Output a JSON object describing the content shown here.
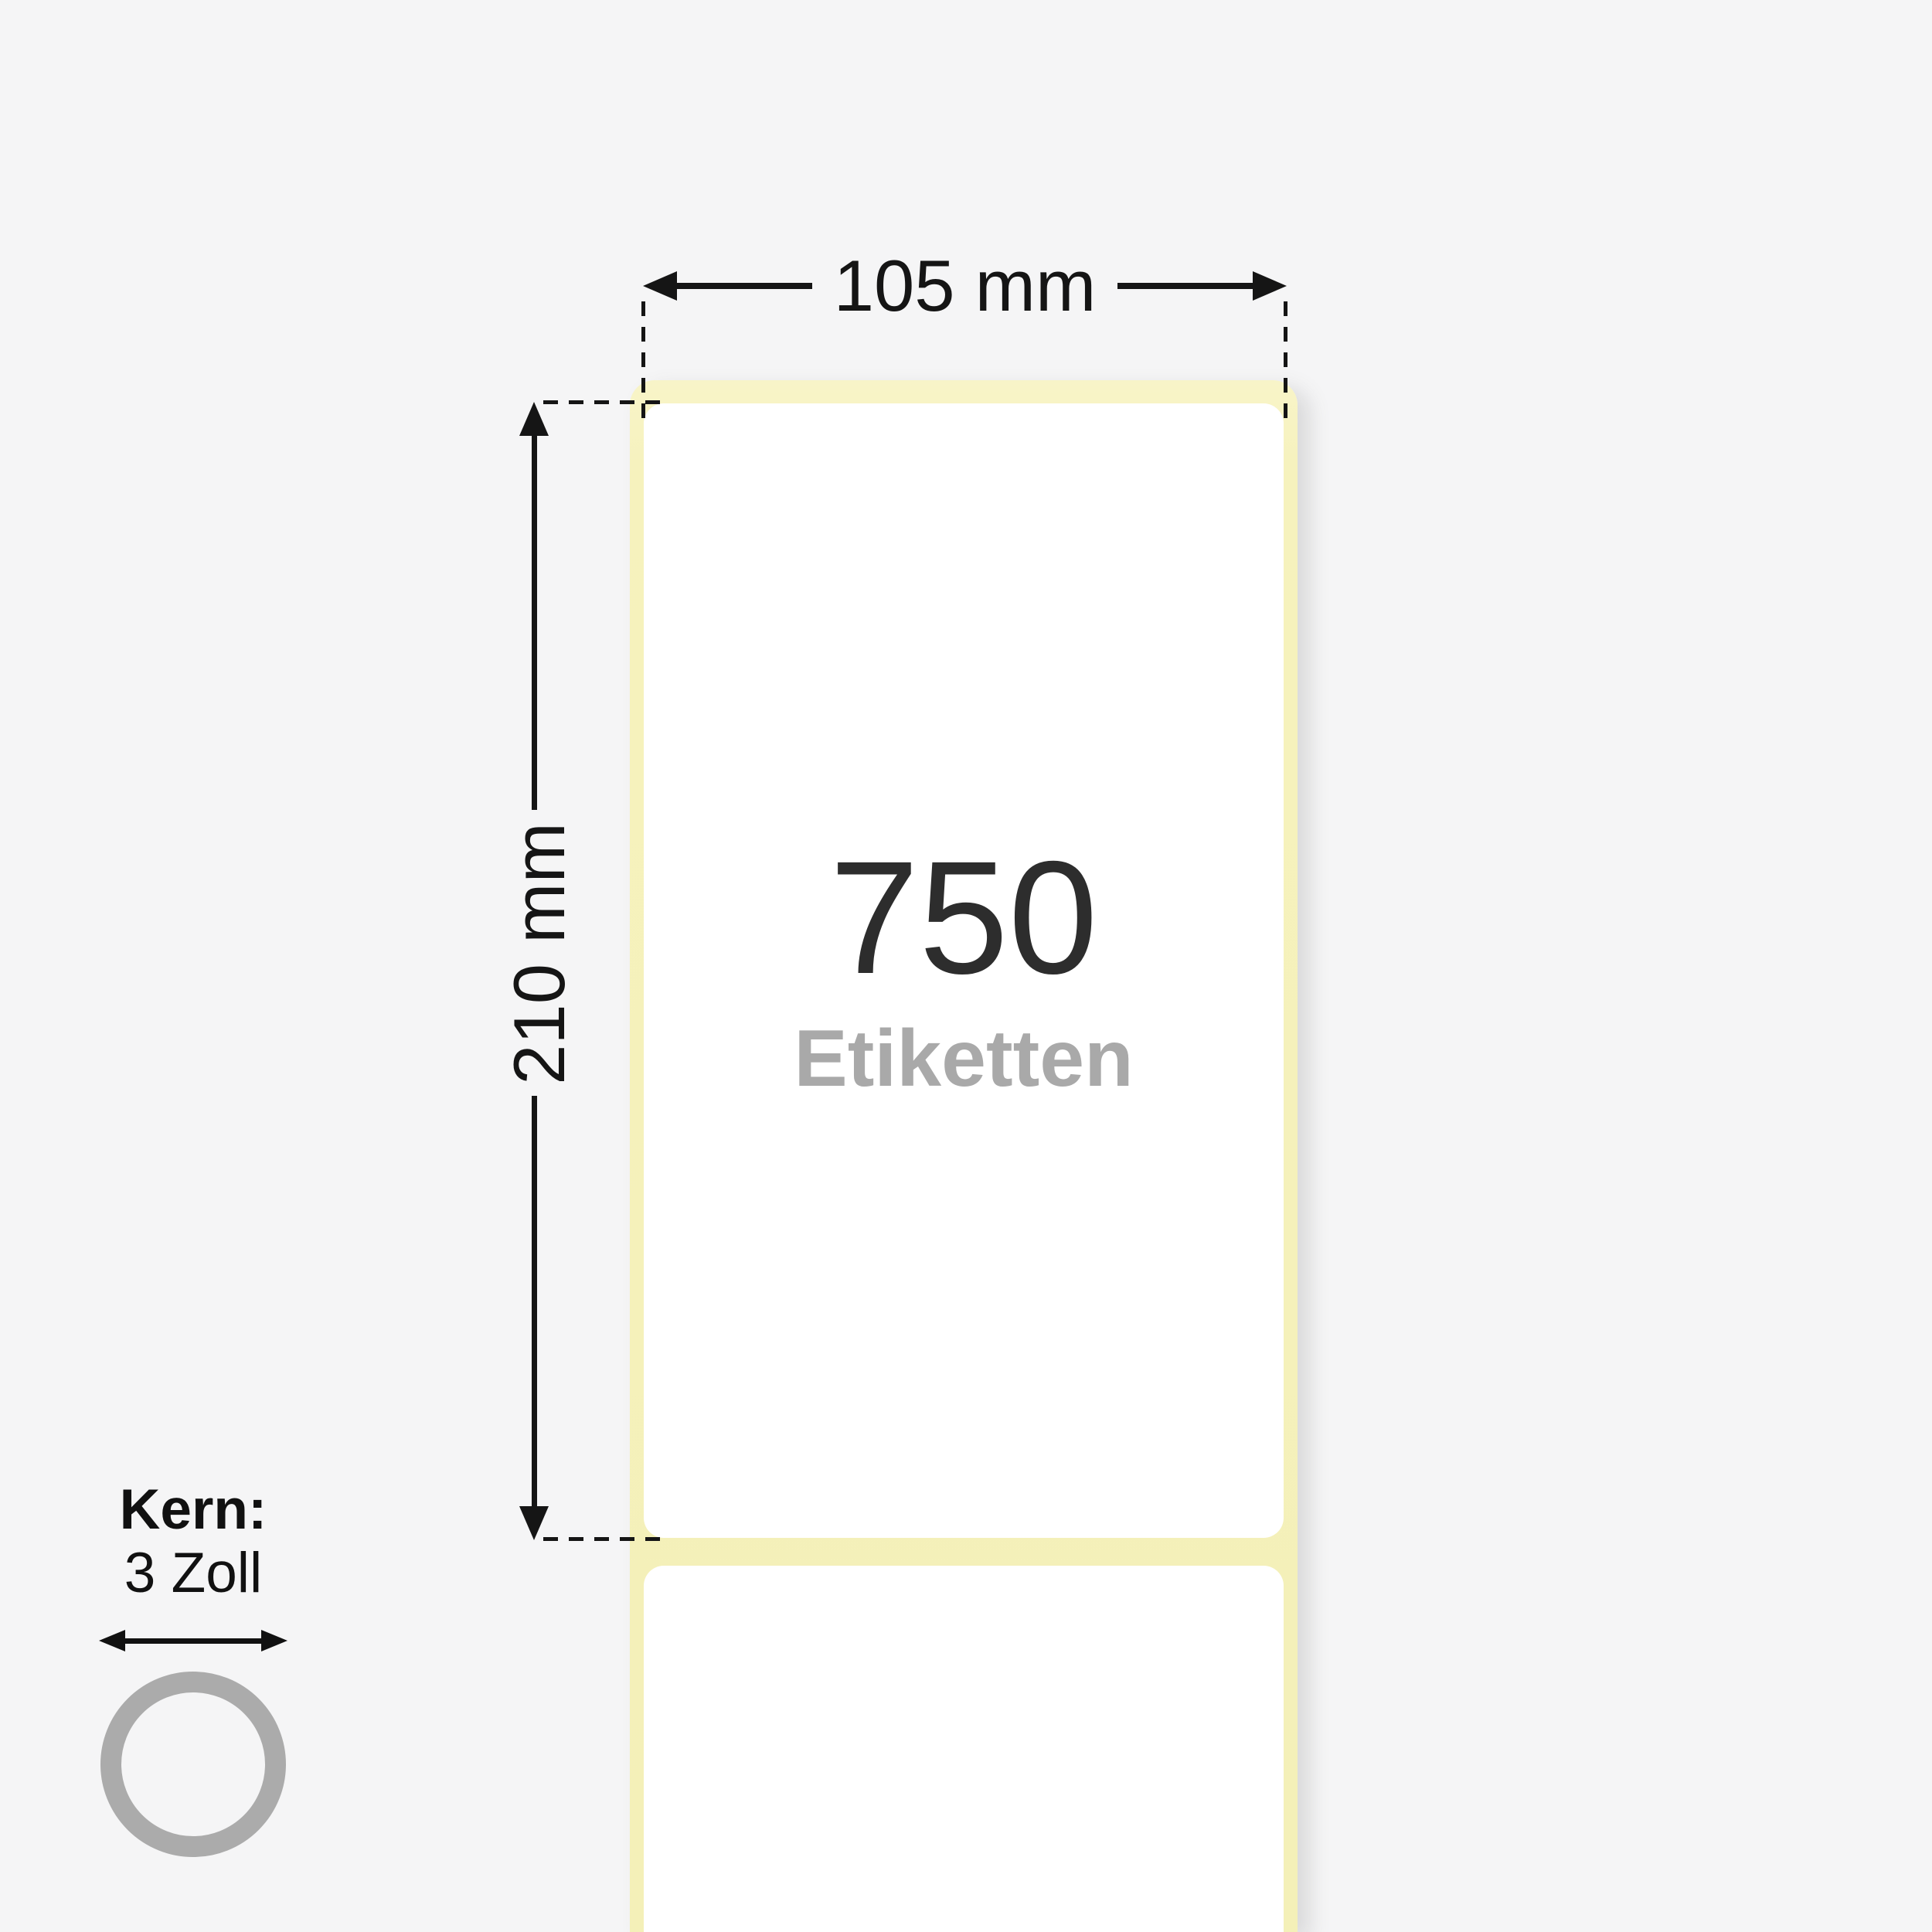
{
  "diagram": {
    "type": "label-roll-dimension-diagram",
    "label_count": "750",
    "label_count_caption": "Etiketten",
    "width_dimension": "105 mm",
    "height_dimension": "210 mm",
    "core": {
      "label": "Kern:",
      "value": "3 Zoll"
    }
  },
  "colors": {
    "background": "#f5f5f6",
    "liner_yellow": "#f6f2bd",
    "label_white": "#ffffff",
    "annotation_black": "#151515",
    "count_text": "#2d2d2d",
    "caption_gray": "#a9a9a9",
    "core_ring_gray": "#ababab"
  },
  "icons": {
    "width_arrows": "left-right-arrowheads",
    "height_arrows": "up-down-arrowheads",
    "core_arrow": "left-right-arrowheads",
    "core_ring": "circle-outline"
  }
}
